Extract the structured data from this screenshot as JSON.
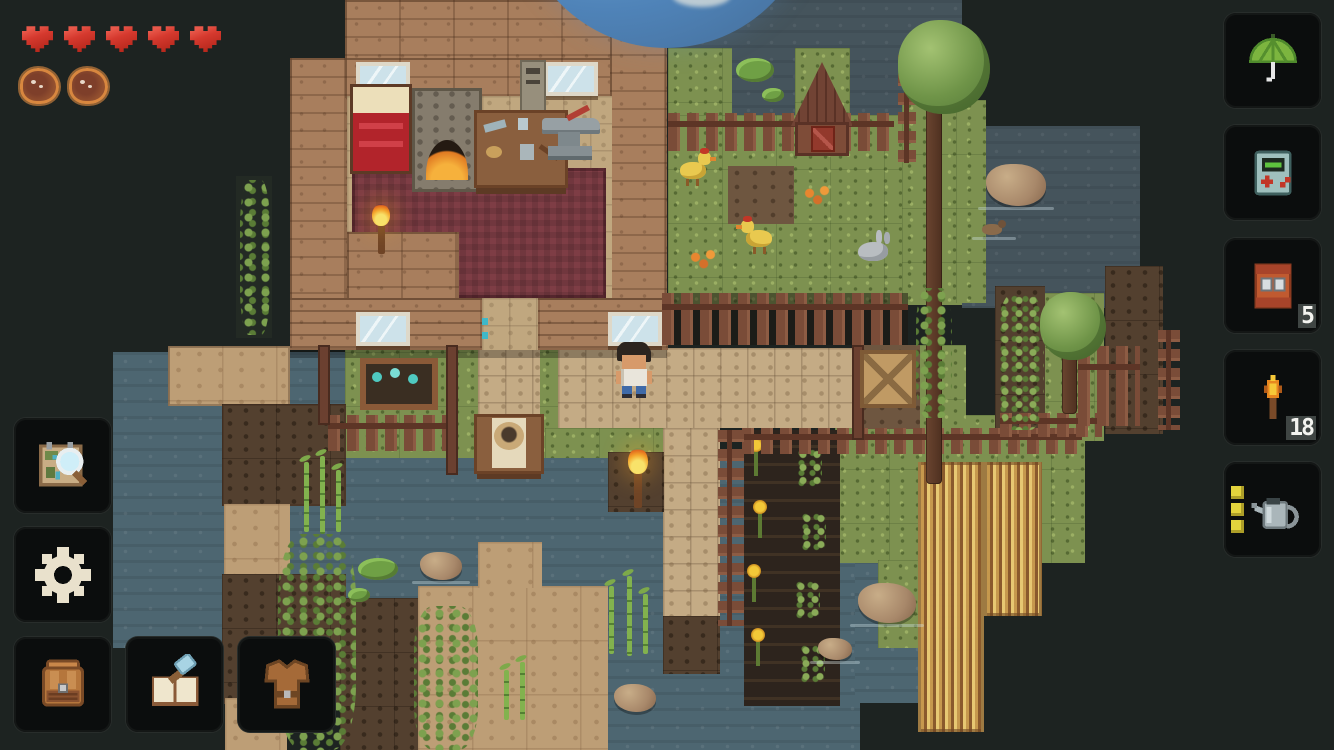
{
  "app": {
    "type": "pixel-art top-down survival game"
  },
  "hud": {
    "health_bar": {
      "hearts_filled": 5,
      "hearts_total": 5,
      "heart_color": "#d5392e"
    },
    "hunger_bar": {
      "meat_filled": 2,
      "meat_total": 2
    },
    "left_panel": {
      "map_button": {
        "icon": "map-magnifier-icon"
      },
      "settings_button": {
        "icon": "gear-icon"
      },
      "inventory_button": {
        "icon": "backpack-icon"
      },
      "crafting_button": {
        "icon": "crafting-book-hammer-icon"
      },
      "equipment_button": {
        "icon": "leather-armor-icon"
      }
    },
    "right_panel": {
      "slots": [
        {
          "id": "glider",
          "icon": "green-umbrella-icon",
          "count": ""
        },
        {
          "id": "gadget",
          "icon": "handheld-console-icon",
          "count": ""
        },
        {
          "id": "cabinet",
          "icon": "orange-cabinet-icon",
          "count": "5"
        },
        {
          "id": "torch",
          "icon": "torch-icon",
          "count": "18"
        },
        {
          "id": "watering_can",
          "icon": "watering-can-icon",
          "count": "",
          "charge_bars": 3
        }
      ]
    }
  },
  "world": {
    "player": "man with dark hair, white tank top, blue jeans, on stone path",
    "animals": [
      "chicken",
      "chicken",
      "rabbit",
      "duck"
    ],
    "structures": [
      "wood house with bed, furnace, crafting table, anvil, maroon carpet, windows, torch",
      "barn",
      "picket fences",
      "crate",
      "flower planter",
      "table with pot",
      "ladder"
    ],
    "vegetation": [
      "trees",
      "bush",
      "vines",
      "bamboo",
      "lily pads",
      "sunflower crops",
      "wheat field"
    ],
    "celestial": "large blue and orange planet on horizon",
    "colors": {
      "bg": "#1d2321",
      "water": "#45545c",
      "waterb": "#4d6671",
      "grass": "#7d9150",
      "path": "#c4ab85",
      "floor": "#c0a77f",
      "wall": "#a87e5d",
      "carpet": "#7e3d45",
      "dirt": "#53402f",
      "dirtl": "#6e5640",
      "sand": "#bd9e76",
      "tilled": "#2d241d",
      "wheat": "#c79c4c",
      "heart": "#d5392e",
      "yellow": "#e3d33d",
      "btn": "#0b0d0d"
    }
  }
}
